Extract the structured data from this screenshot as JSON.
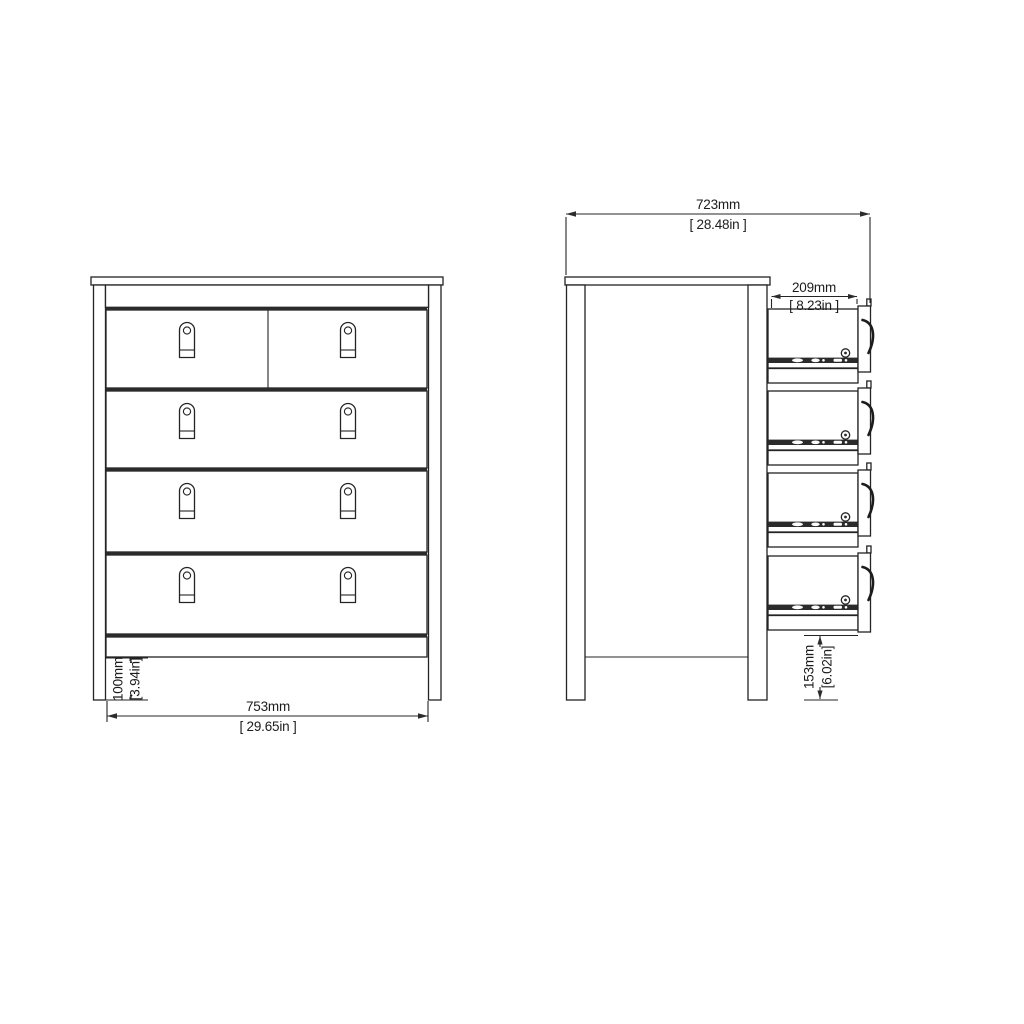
{
  "drawing": {
    "front_view": {
      "width_dim": {
        "metric": "753mm",
        "imperial": "[ 29.65in ]"
      },
      "plinth_dim": {
        "metric": "100mm",
        "imperial": "[3.94in]"
      }
    },
    "side_view": {
      "total_width_dim": {
        "metric": "723mm",
        "imperial": "[ 28.48in ]"
      },
      "drawer_depth_dim": {
        "metric": "209mm",
        "imperial": "[ 8.23in ]"
      },
      "clearance_dim": {
        "metric": "153mm",
        "imperial": "[6.02in]"
      }
    }
  }
}
